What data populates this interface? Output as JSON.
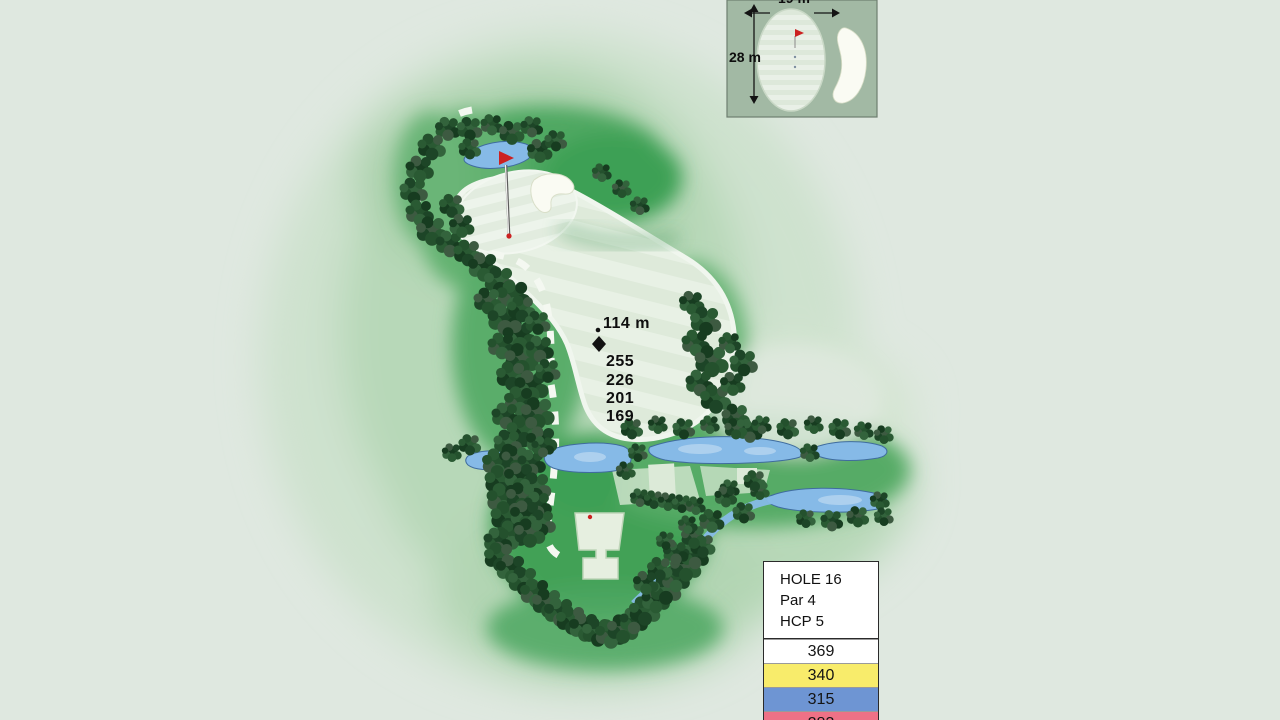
{
  "palette": {
    "background": "#dfe8e0",
    "water": "#86bae7",
    "sand": "#fafbf3",
    "flag_red": "#cc2121",
    "tree_green": "#26552f"
  },
  "inset": {
    "width_label": "19 m",
    "depth_label": "28 m"
  },
  "markers": {
    "pin_distance": "114 m",
    "tee_distances": [
      "255",
      "226",
      "201",
      "169"
    ]
  },
  "info_box": {
    "hole_label": "HOLE 16",
    "par_label": "Par 4",
    "hcp_label": "HCP 5",
    "tee_rows": [
      {
        "distance": "369",
        "color": "#ffffff"
      },
      {
        "distance": "340",
        "color": "#f8ec6b"
      },
      {
        "distance": "315",
        "color": "#6e95d3"
      },
      {
        "distance": "283",
        "color": "#ee7186"
      }
    ]
  }
}
